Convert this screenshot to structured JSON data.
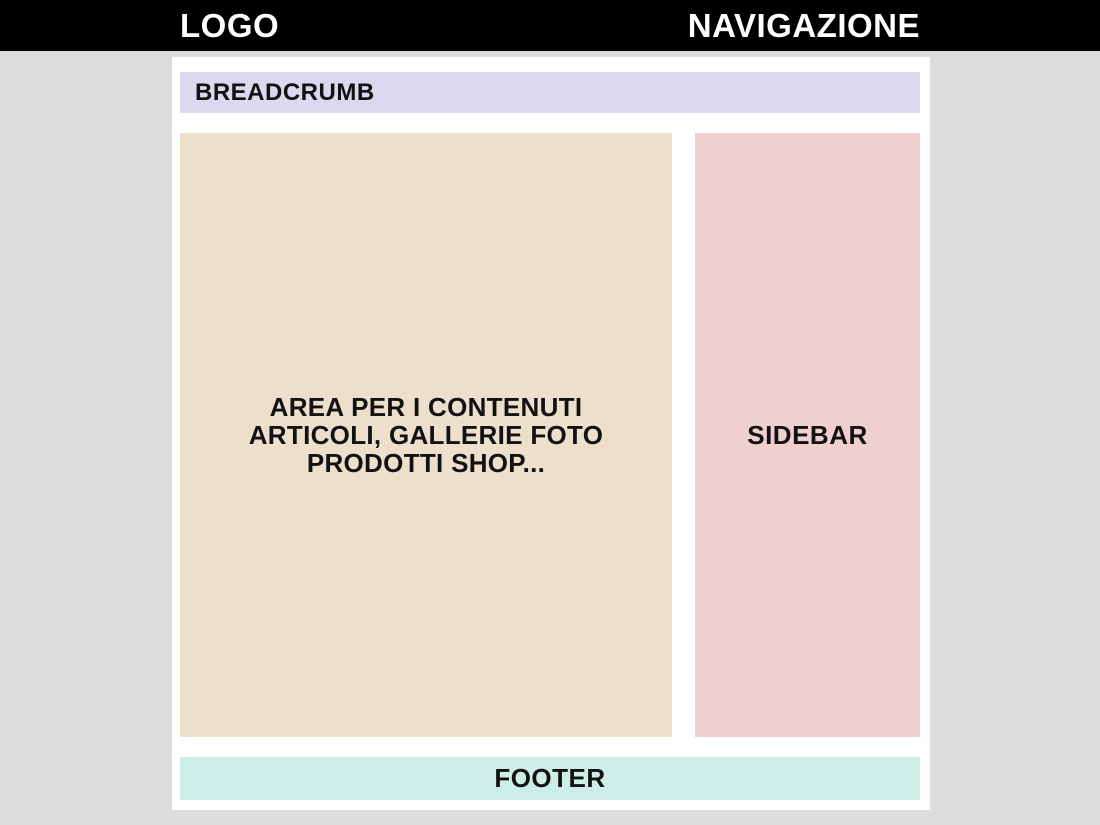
{
  "header": {
    "logo_label": "LOGO",
    "nav_label": "NAVIGAZIONE"
  },
  "breadcrumb": {
    "label": "BREADCRUMB"
  },
  "content": {
    "lines": [
      "AREA PER I CONTENUTI",
      "ARTICOLI, GALLERIE FOTO",
      "PRODOTTI SHOP..."
    ]
  },
  "sidebar": {
    "label": "SIDEBAR"
  },
  "footer": {
    "label": "FOOTER"
  },
  "colors": {
    "page_background": "#dcdcdc",
    "header_bg": "#000000",
    "header_text": "#ffffff",
    "container_bg": "#ffffff",
    "breadcrumb_bg": "#dbd8f0",
    "content_bg": "#ecdfcc",
    "sidebar_bg": "#f0cfcf",
    "footer_bg": "#cdeee6",
    "body_text": "#121212"
  }
}
